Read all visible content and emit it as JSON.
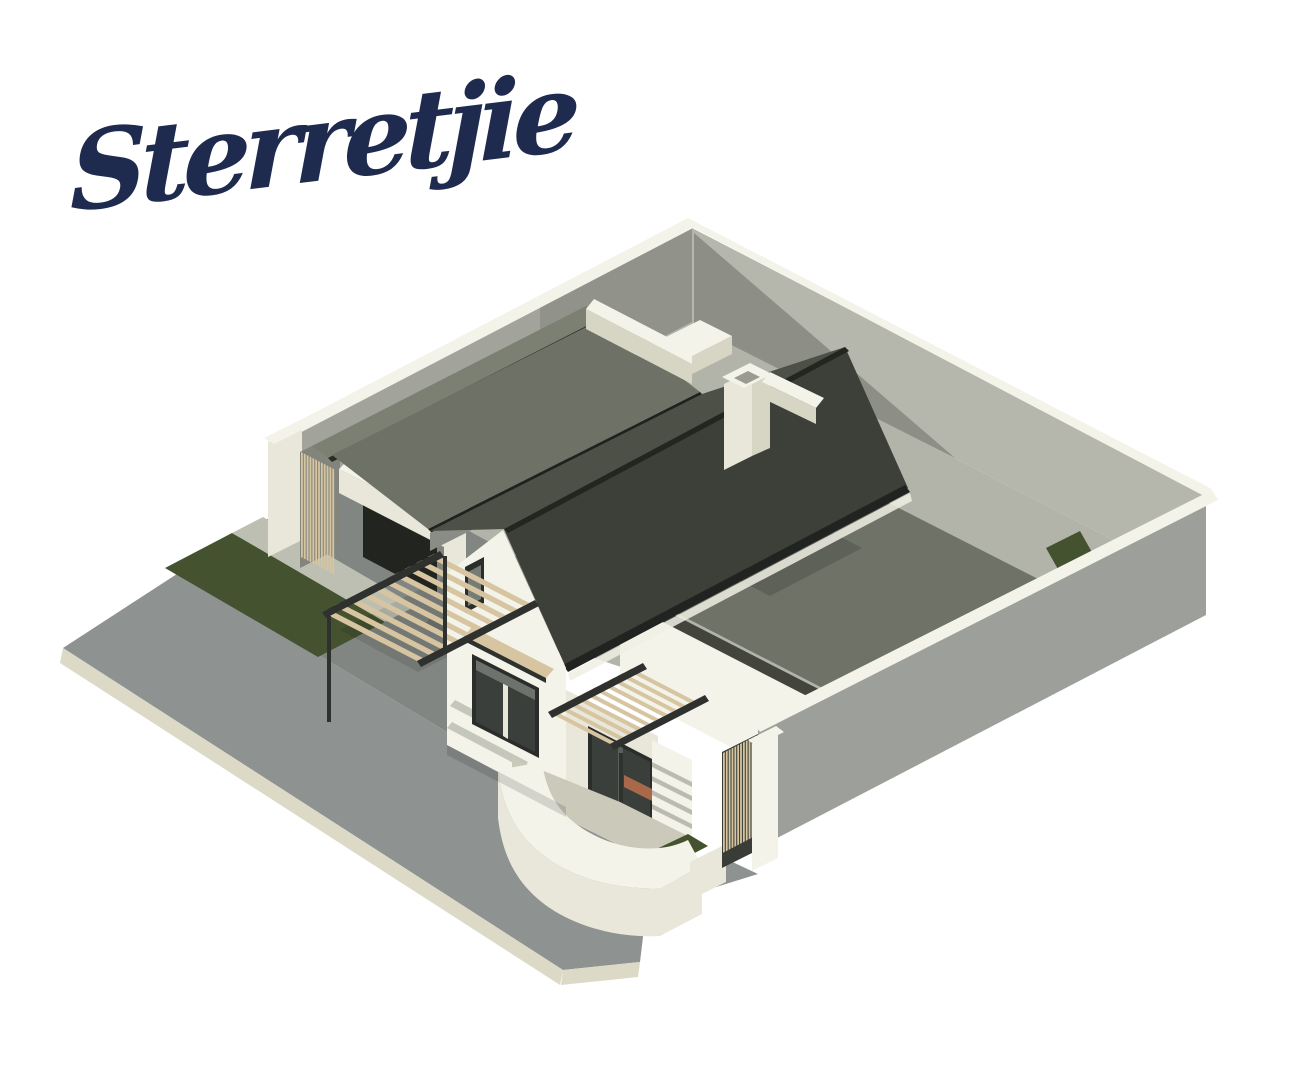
{
  "logo": {
    "text": "Sterretjie",
    "color": "#1f2b4e"
  },
  "scene": {
    "description": "3D isometric architectural rendering of a white Cape-vernacular style single-storey house with twin dark gabled roofs and end parapets, a flat-roofed side wing, garage, timber slat pergolas and screens, a curved white entrance-courtyard wall, cream boundary walls around the plot, lawn strips and grey street paving on a corner stand",
    "palette": {
      "navy": "#1f2b4e",
      "creamBright": "#f4f3ea",
      "cream": "#e8e7d9",
      "creamShade": "#d7d6c5",
      "wallGrayLight": "#b5b6ac",
      "wallGray": "#a2a39a",
      "wallGrayDark": "#83857c",
      "wallOuter": "#9da09a",
      "groundBase": "#b2b3a9",
      "roofDark": "#3d4038",
      "roofDarker": "#23261f",
      "roofGap": "#4d5047",
      "roofMid": "#6e7266",
      "roofMidLight": "#7c8073",
      "wingRoof": "#6f7267",
      "wingRoofShadow": "#585c51",
      "fascia": "#43453d",
      "glass": "#3b3f3b",
      "frame": "#2a2d29",
      "pavement": "#8e9290",
      "curb": "#dcdac7",
      "curbGreen": "#c6c9b2",
      "apron": "#828682",
      "concrete": "#bcbfb1",
      "concreteLight": "#cac9ba",
      "grass": "#44522f",
      "timber": "#d6c5a0",
      "steel": "#2e312d",
      "terracotta": "#a8684a",
      "eaveLine": "#1e211c",
      "gutterWhite": "#f0efe4"
    }
  }
}
